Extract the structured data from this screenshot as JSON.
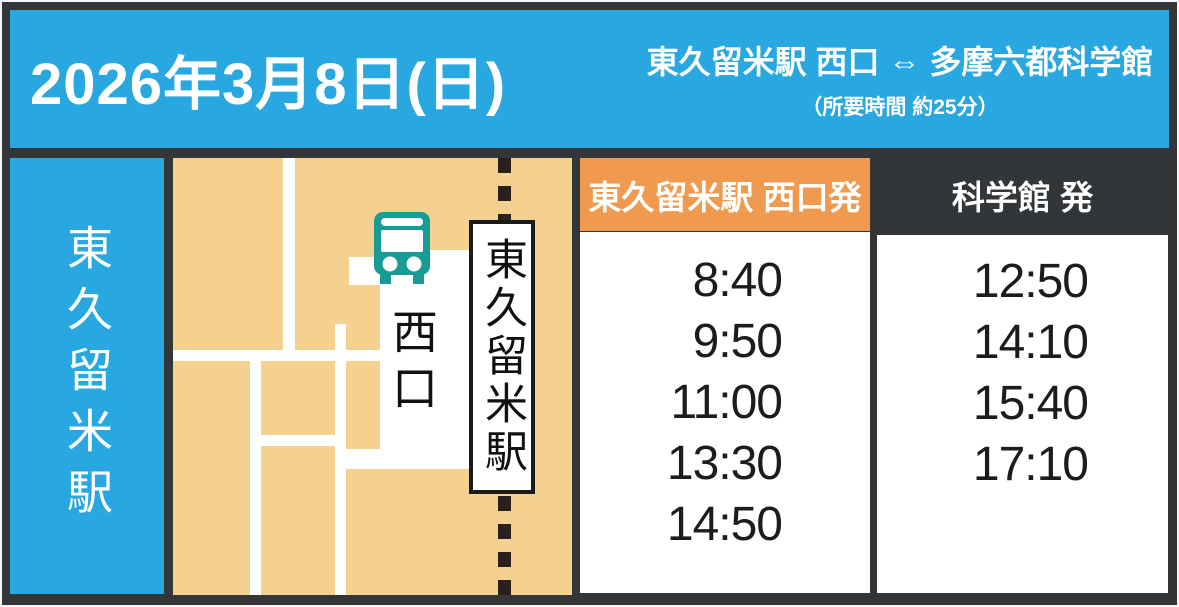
{
  "header": {
    "date": "2026年3月8日(日)",
    "route": "東久留米駅 西口 ⇔ 多摩六都科学館",
    "duration_note": "（所要時間 約25分）"
  },
  "sidebar": {
    "station_label": "東久留米駅"
  },
  "map": {
    "station_sign_label": "東久留米駅",
    "west_exit_label": "西口",
    "icons": {
      "bus": "bus-icon",
      "railway": "dashed-railway-line"
    }
  },
  "timetable": {
    "columns": [
      {
        "header": "東久留米駅 西口発",
        "times": [
          "8:40",
          "9:50",
          "11:00",
          "13:30",
          "14:50"
        ]
      },
      {
        "header": "科学館 発",
        "times": [
          "12:50",
          "14:10",
          "15:40",
          "17:10"
        ]
      }
    ]
  },
  "colors": {
    "header_blue": "#29a7e1",
    "map_tan": "#f4d18e",
    "station_header_orange": "#ef9a4f",
    "bus_teal": "#169c94",
    "frame_dark": "#333639"
  }
}
